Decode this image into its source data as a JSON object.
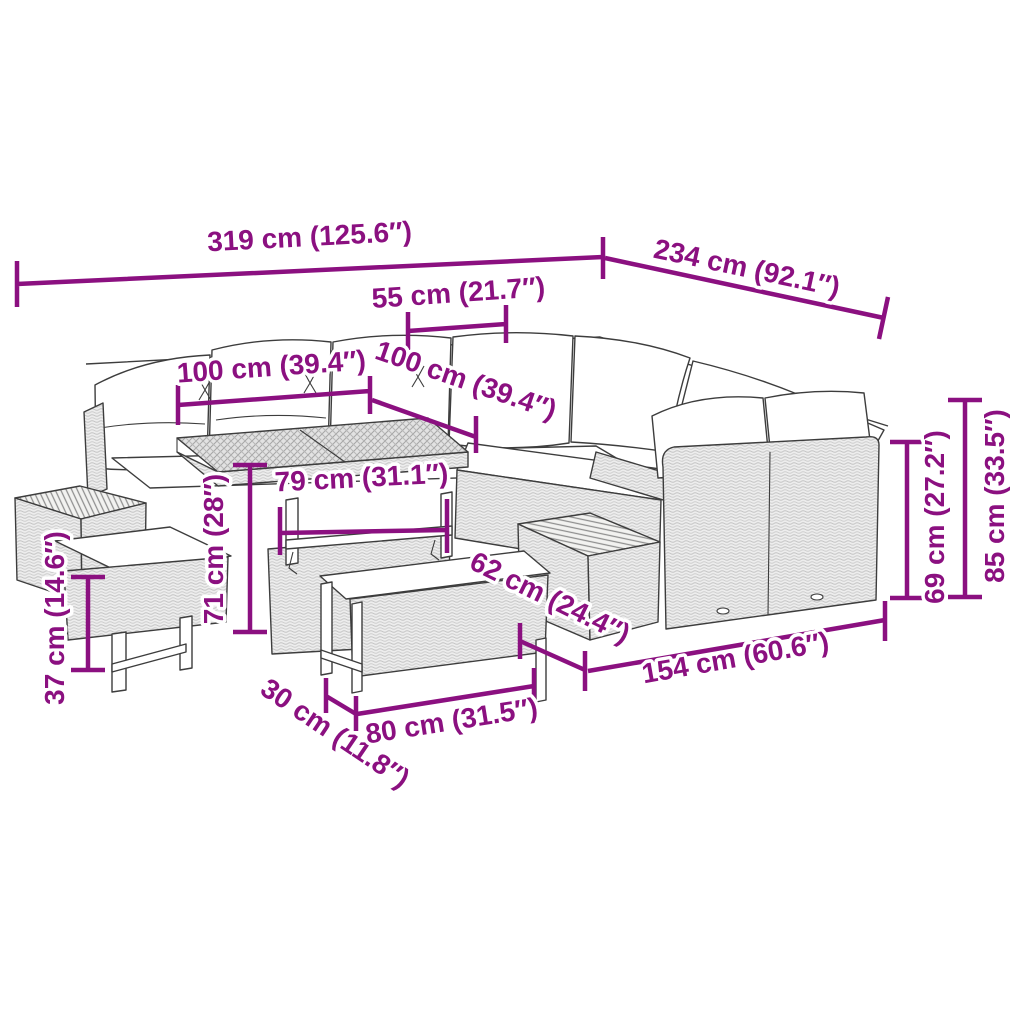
{
  "diagram": {
    "title": "poly-rattan-garden-lounge-set-dimension-diagram",
    "accent_color": "#8B1080",
    "outline_color": "#3D3D3D",
    "background_color": "#FFFFFF",
    "unit_primary": "cm",
    "unit_secondary": "in",
    "dimensions": [
      {
        "id": "total-width",
        "label": "319 cm (125.6″)"
      },
      {
        "id": "total-depth",
        "label": "234 cm (92.1″)"
      },
      {
        "id": "arm-section-width",
        "label": "55 cm (21.7″)"
      },
      {
        "id": "table-length",
        "label": "100 cm (39.4″)"
      },
      {
        "id": "table-depth",
        "label": "100 cm (39.4″)"
      },
      {
        "id": "table-frame-width",
        "label": "79 cm (31.1″)"
      },
      {
        "id": "table-height",
        "label": "71 cm (28″)"
      },
      {
        "id": "sofa-seat-depth",
        "label": "62 cm (24.4″)"
      },
      {
        "id": "sofa-section-length",
        "label": "154 cm (60.6″)"
      },
      {
        "id": "backrest-height",
        "label": "69 cm (27.2″)"
      },
      {
        "id": "total-height",
        "label": "85 cm (33.5″)"
      },
      {
        "id": "bench-height",
        "label": "37 cm (14.6″)"
      },
      {
        "id": "bench-depth",
        "label": "30 cm (11.8″)"
      },
      {
        "id": "bench-length",
        "label": "80 cm (31.5″)"
      }
    ]
  }
}
